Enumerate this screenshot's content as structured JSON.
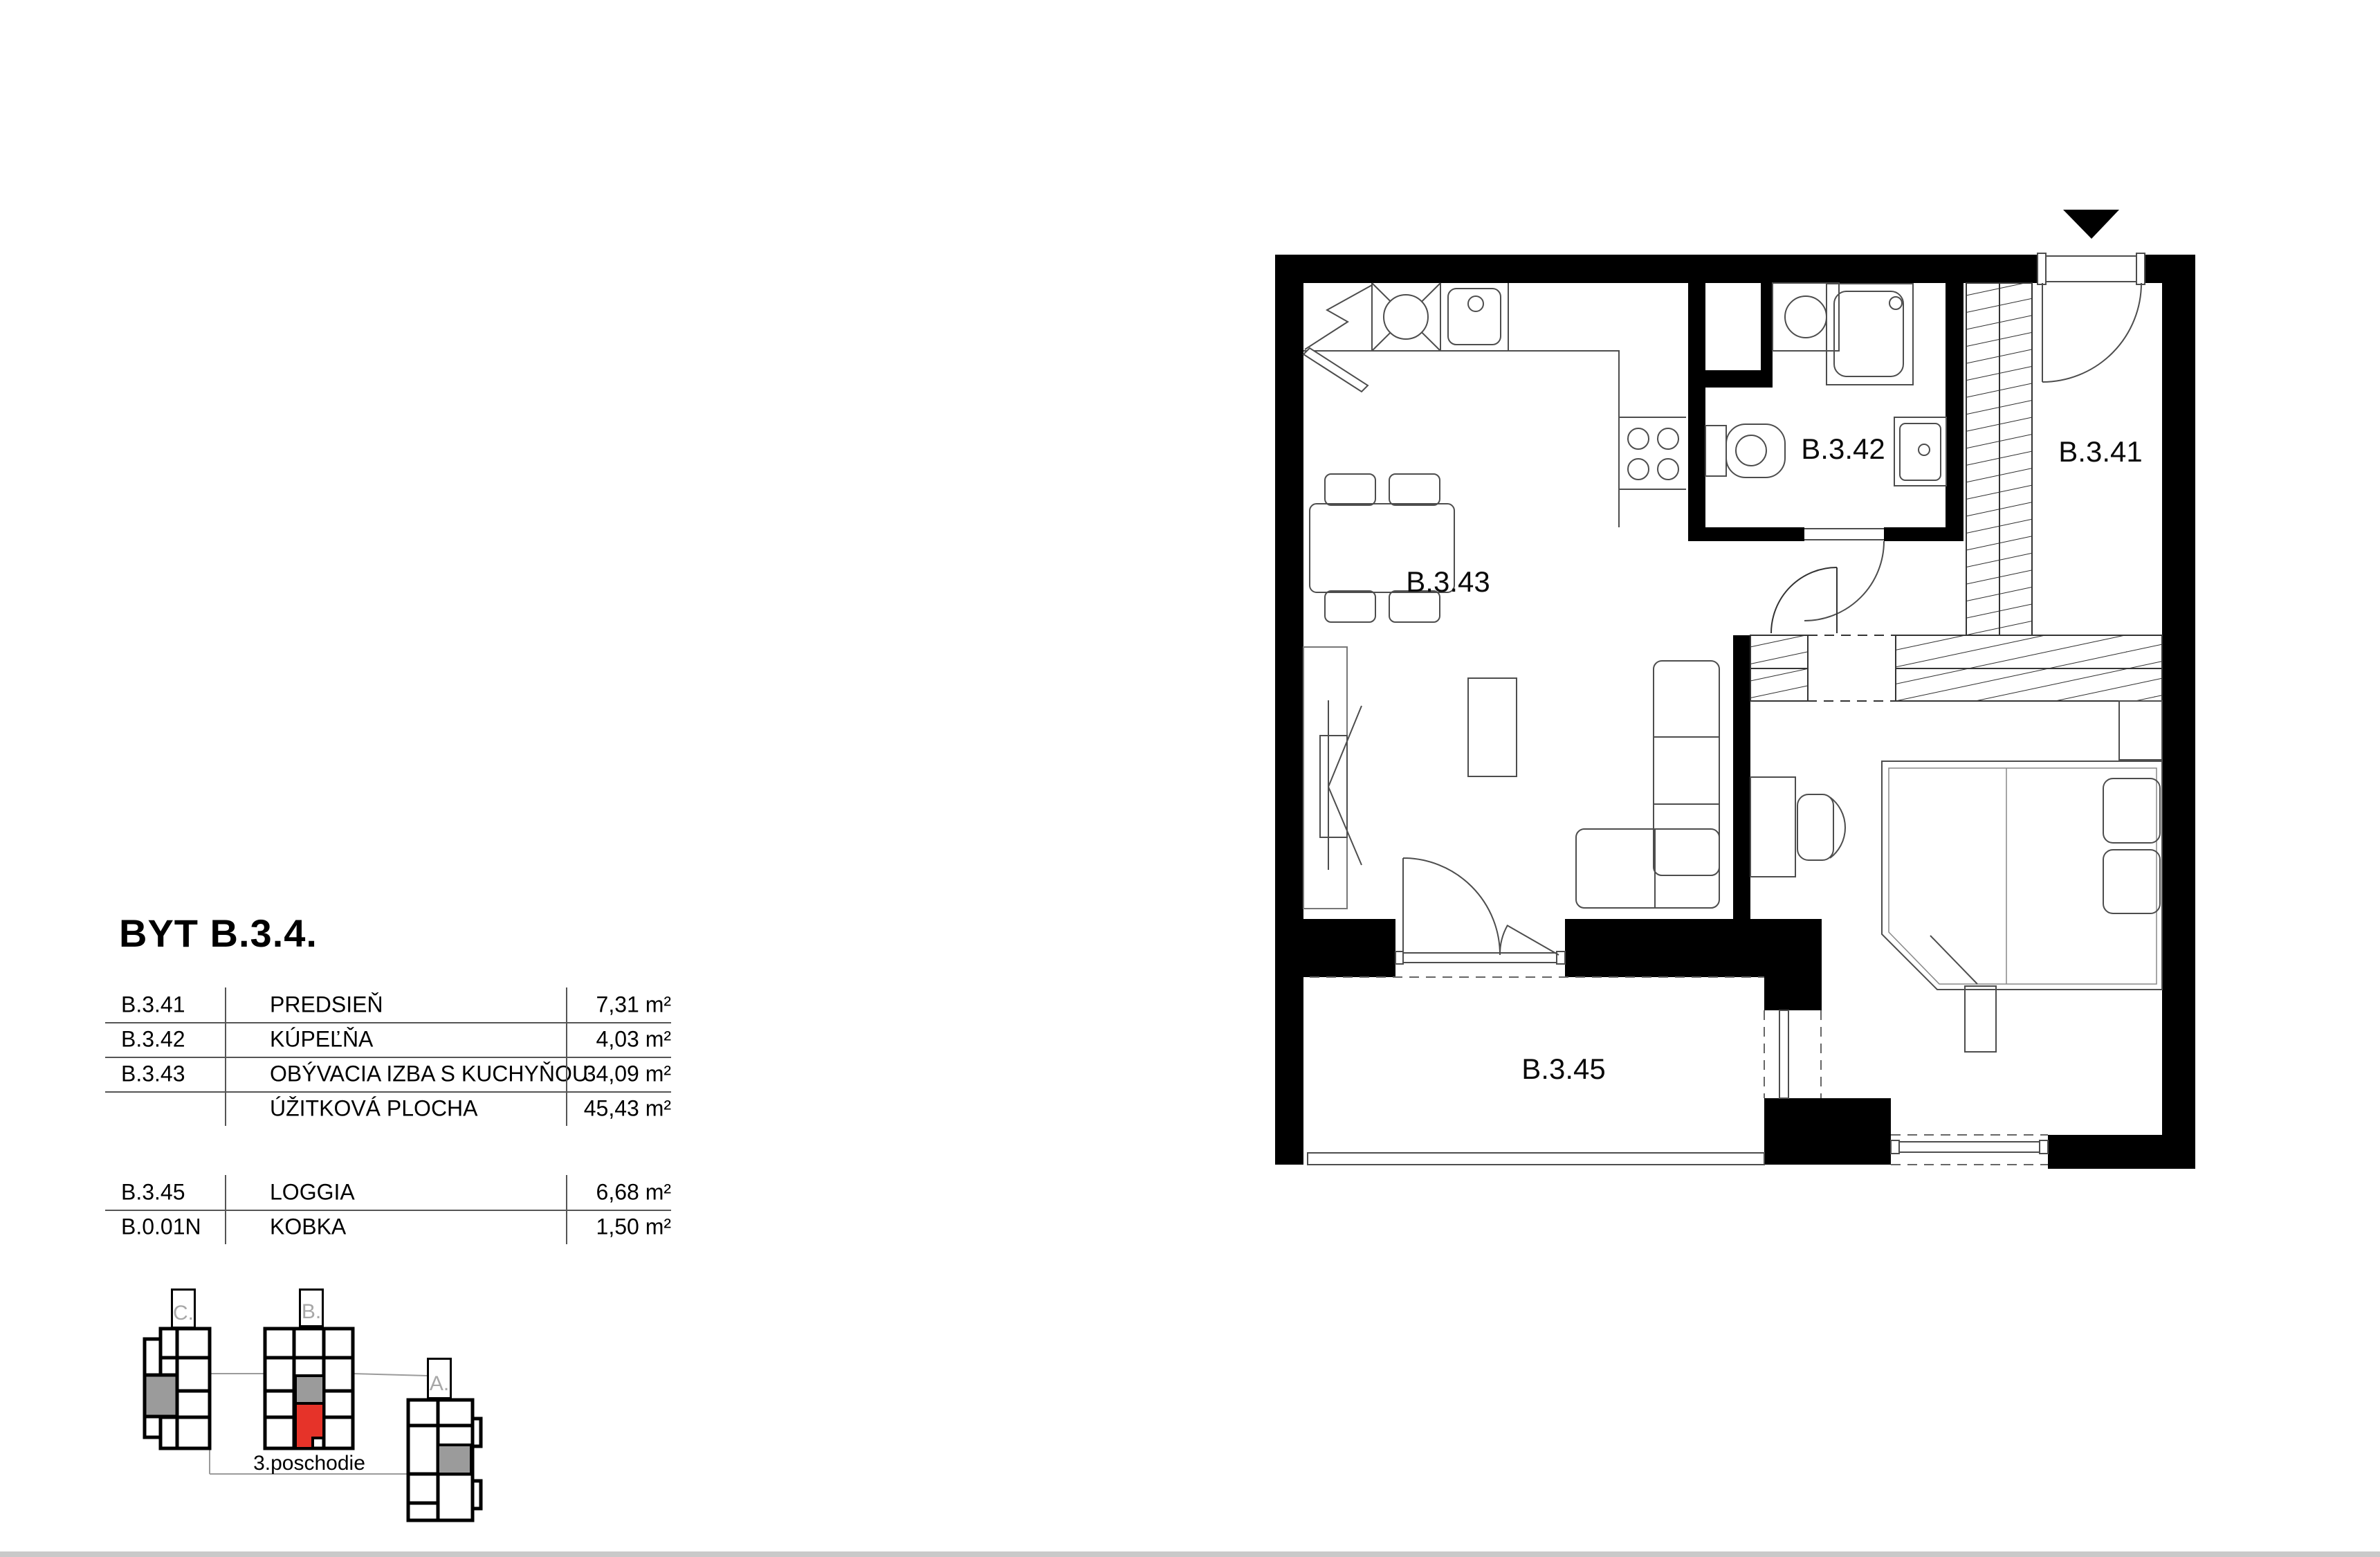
{
  "title": "BYT B.3.4.",
  "tables": {
    "main": {
      "rows": [
        {
          "code": "B.3.41",
          "name": "PREDSIEŇ",
          "area": "7,31 m²"
        },
        {
          "code": "B.3.42",
          "name": "KÚPEĽŇA",
          "area": "4,03 m²"
        },
        {
          "code": "B.3.43",
          "name": "OBÝVACIA IZBA S KUCHYŇOU",
          "area": "34,09 m²"
        },
        {
          "code": "",
          "name": "ÚŽITKOVÁ PLOCHA",
          "area": "45,43 m²"
        }
      ]
    },
    "extras": {
      "rows": [
        {
          "code": "B.3.45",
          "name": "LOGGIA",
          "area": "6,68 m²"
        },
        {
          "code": "B.0.01N",
          "name": "KOBKA",
          "area": "1,50 m²"
        }
      ]
    }
  },
  "floor_plan": {
    "rooms": [
      {
        "label": "B.3.41"
      },
      {
        "label": "B.3.42"
      },
      {
        "label": "B.3.43"
      },
      {
        "label": "B.3.45"
      }
    ]
  },
  "site_plan": {
    "buildings": [
      {
        "label": "C."
      },
      {
        "label": "B."
      },
      {
        "label": "A."
      }
    ],
    "floor_label": "3.poschodie"
  },
  "colors": {
    "highlight_red": "#e63329",
    "muted_gray": "#9b9b9b",
    "wall_black": "#000000"
  }
}
